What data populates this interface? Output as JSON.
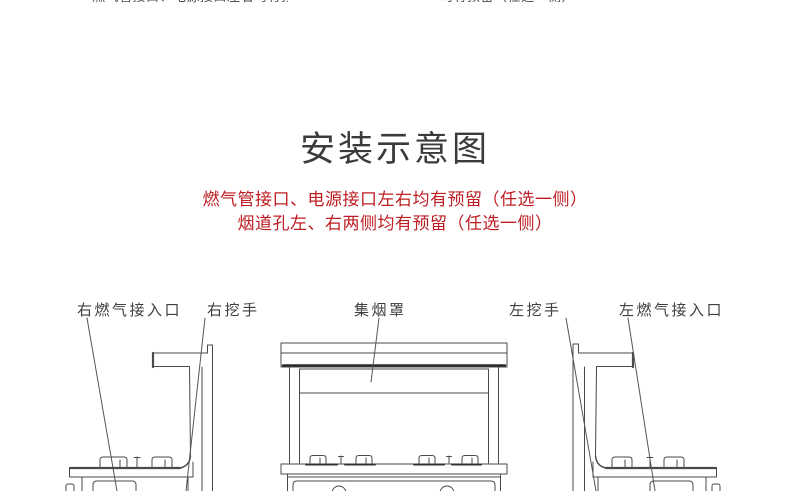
{
  "top_cutoff": {
    "left_fragment": "燃气管接口、电源接口左右均有预留",
    "right_fragment": "均有预留（任选一侧）"
  },
  "section": {
    "title": "安装示意图",
    "notice_line1": "燃气管接口、电源接口左右均有预留（任选一侧）",
    "notice_line2": "烟道孔左、右两侧均有预留（任选一侧）"
  },
  "diagram": {
    "labels": [
      {
        "id": "right-gas-inlet",
        "text": "右燃气接入口"
      },
      {
        "id": "right-recessed-handle",
        "text": "右挖手"
      },
      {
        "id": "smoke-collection-hood",
        "text": "集烟罩"
      },
      {
        "id": "left-recessed-handle",
        "text": "左挖手"
      },
      {
        "id": "left-gas-inlet",
        "text": "左燃气接入口"
      }
    ],
    "views": [
      "right-side-view",
      "front-view",
      "left-side-view"
    ]
  },
  "colors": {
    "notice_red": "#be1e23",
    "title_gray": "#3b3b3b",
    "line_gray": "#4a4a4a"
  }
}
